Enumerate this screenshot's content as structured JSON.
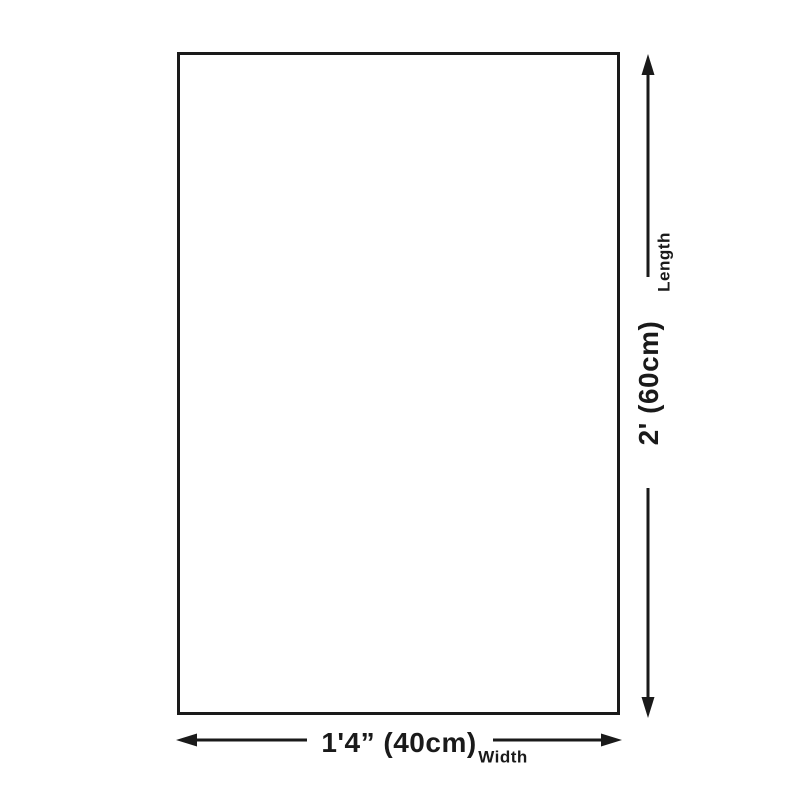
{
  "diagram": {
    "title": "product-dimension-diagram",
    "colors": {
      "background": "#ffffff",
      "line": "#1a1a1a",
      "text": "#1a1a1a"
    },
    "length": {
      "caption": "Length",
      "value": "2' (60cm)"
    },
    "width": {
      "caption": "Width",
      "value": "1'4” (40cm)"
    }
  }
}
